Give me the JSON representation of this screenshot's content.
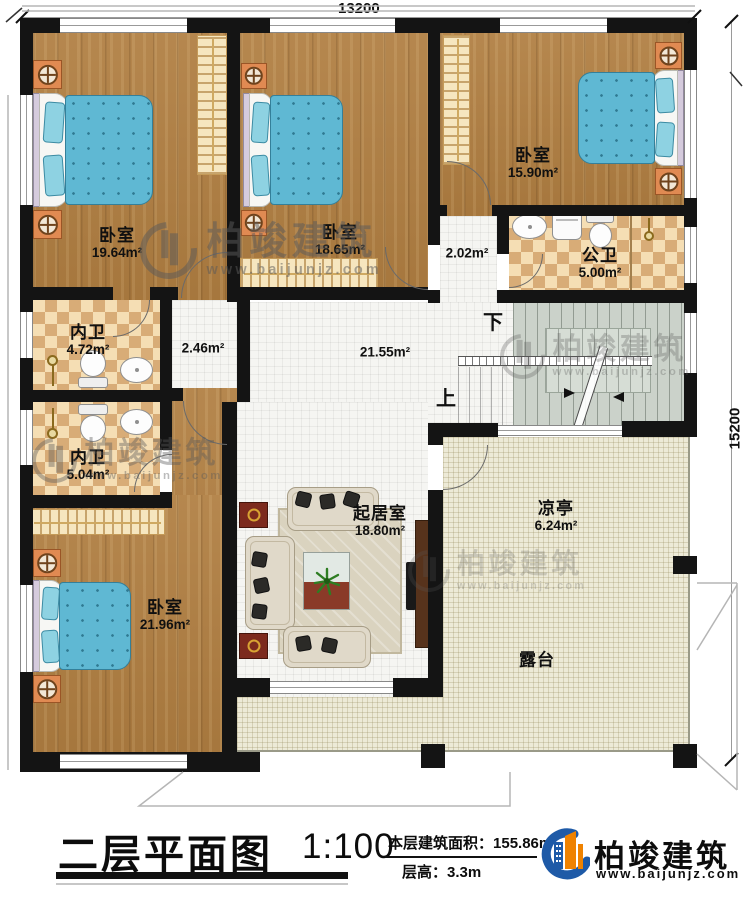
{
  "plan": {
    "dim_top": "13200",
    "dim_right": "15200",
    "stairs_up": "上",
    "stairs_down": "下",
    "rooms": {
      "bedroom_tl": {
        "name": "卧室",
        "area": "19.64m²"
      },
      "bedroom_tm": {
        "name": "卧室",
        "area": "18.65m²"
      },
      "bedroom_tr": {
        "name": "卧室",
        "area": "15.90m²"
      },
      "public_bath": {
        "name": "公卫",
        "area": "5.00m²"
      },
      "corridor_small": {
        "area": "2.02m²"
      },
      "ensuite_1": {
        "name": "内卫",
        "area": "4.72m²"
      },
      "vestibule": {
        "area": "2.46m²"
      },
      "hall": {
        "area": "21.55m²"
      },
      "ensuite_2": {
        "name": "内卫",
        "area": "5.04m²"
      },
      "bedroom_bl": {
        "name": "卧室",
        "area": "21.96m²"
      },
      "living": {
        "name": "起居室",
        "area": "18.80m²"
      },
      "pavilion": {
        "name": "凉亭",
        "area": "6.24m²"
      },
      "terrace": {
        "name": "露台"
      }
    }
  },
  "watermark": {
    "brand": "柏竣建筑",
    "url": "www.baijunjz.com"
  },
  "titleblock": {
    "title": "二层平面图",
    "scale": "1:100",
    "area_label": "本层建筑面积：",
    "area_value": "155.86m²",
    "height_label": "层高：",
    "height_value": "3.3m",
    "brand": "柏竣建筑",
    "brand_url": "www.baijunjz.com"
  }
}
